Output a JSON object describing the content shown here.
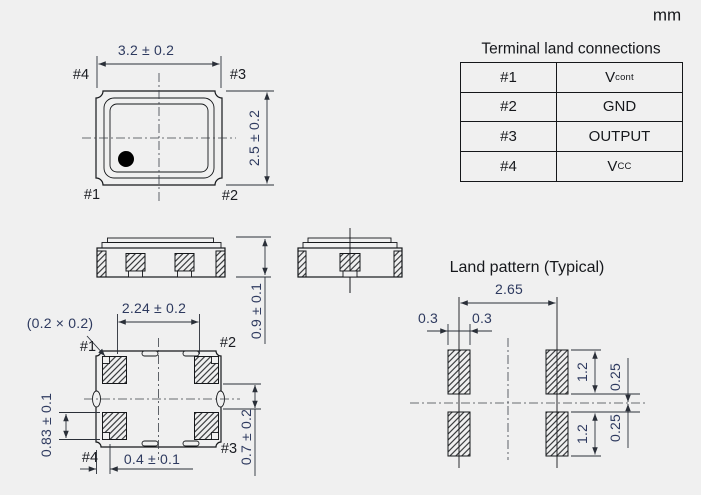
{
  "unit_label": "mm",
  "terminal_table": {
    "title": "Terminal land connections",
    "rows": [
      {
        "terminal": "#1",
        "signal_main": "V",
        "signal_sub": "cont"
      },
      {
        "terminal": "#2",
        "signal_main": "GND",
        "signal_sub": ""
      },
      {
        "terminal": "#3",
        "signal_main": "OUTPUT",
        "signal_sub": ""
      },
      {
        "terminal": "#4",
        "signal_main": "V",
        "signal_sub": "CC"
      }
    ]
  },
  "top_view": {
    "width_dim": "3.2 ± 0.2",
    "height_dim": "2.5 ± 0.2",
    "pin_labels": {
      "top_left": "#4",
      "top_right": "#3",
      "bottom_left": "#1",
      "bottom_right": "#2"
    }
  },
  "side_view": {
    "height_dim": "0.9 ± 0.1"
  },
  "bottom_view": {
    "pad_span_dim": "2.24 ± 0.2",
    "corner_notch_dim": "(0.2 × 0.2)",
    "pad_height_dim": "0.83 ± 0.1",
    "pad_offset_dim": "0.4 ± 0.1",
    "pad_gap_dim": "0.7 ± 0.2",
    "pin_labels": {
      "top_left": "#1",
      "top_right": "#2",
      "bottom_left": "#4",
      "bottom_right": "#3"
    }
  },
  "land_pattern": {
    "title": "Land pattern (Typical)",
    "pitch_dim": "2.65",
    "pad_half_width_left": "0.3",
    "pad_half_width_right": "0.3",
    "pad_length_top": "1.2",
    "pad_length_bottom": "1.2",
    "center_gap_top": "0.25",
    "center_gap_bottom": "0.25"
  },
  "colors": {
    "background": "#f0f0f0",
    "line": "#15171a",
    "dimension_text": "#2e3a5f"
  }
}
